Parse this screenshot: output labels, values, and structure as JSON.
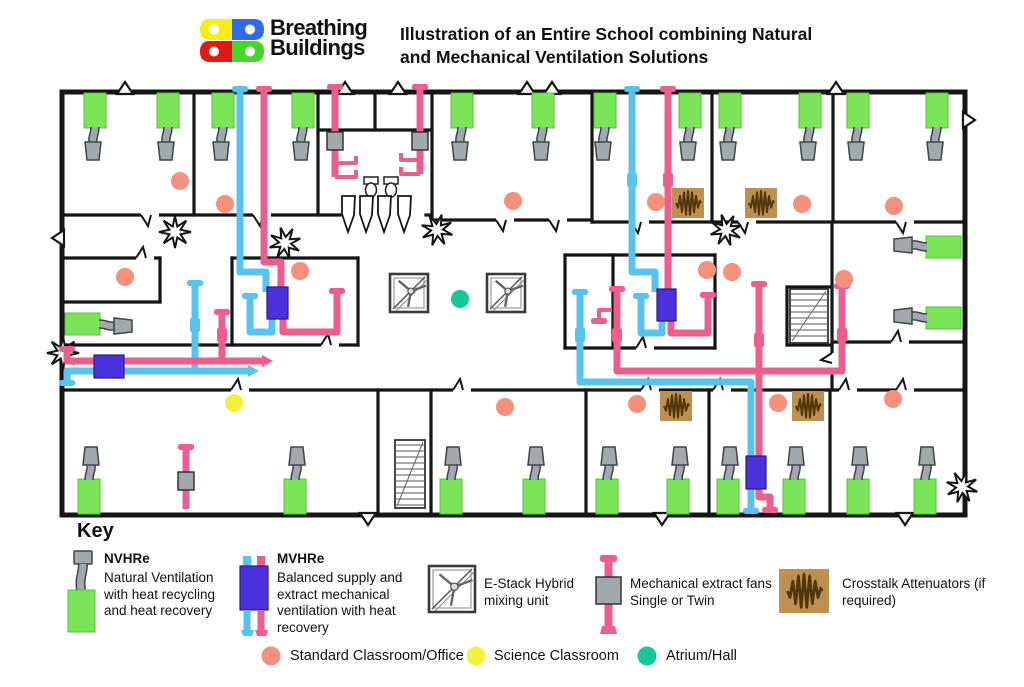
{
  "header": {
    "logo_line1": "Breathing",
    "logo_line2": "Buildings",
    "title_line1": "Illustration of an Entire School combining Natural",
    "title_line2": "and Mechanical Ventilation Solutions"
  },
  "key": {
    "heading": "Key",
    "items": [
      {
        "icon": "key-nvhre-icon",
        "title": "NVHRe",
        "desc": "Natural Ventilation with heat recycling and heat recovery"
      },
      {
        "icon": "key-mvhre-icon",
        "title": "MVHRe",
        "desc": "Balanced supply and extract mechanical ventilation with heat recovery"
      },
      {
        "icon": "key-estack-icon",
        "title": "",
        "desc": "E-Stack Hybrid mixing unit"
      },
      {
        "icon": "key-extract-fan-icon",
        "title": "",
        "desc": "Mechanical extract fans Single or Twin"
      },
      {
        "icon": "key-attenuator-icon",
        "title": "",
        "desc": "Crosstalk Attenuators (if required)"
      }
    ],
    "room_types": [
      {
        "icon": "standard-room-dot",
        "label": "Standard Classroom/Office",
        "color": "#F4907B"
      },
      {
        "icon": "science-room-dot",
        "label": "Science Classroom",
        "color": "#F2F23D"
      },
      {
        "icon": "atrium-room-dot",
        "label": "Atrium/Hall",
        "color": "#17C795"
      }
    ]
  },
  "colors": {
    "wall": "#151515",
    "green": "#79E557",
    "green_stroke": "#57BE3E",
    "gray": "#A2A9AC",
    "gray_stroke": "#3E4448",
    "blue": "#57C4F0",
    "pink": "#EE5E8D",
    "purple": "#4B31DB",
    "purple_stroke": "#2A1880",
    "salmon": "#F4907B",
    "yellow": "#F2F23D",
    "teal": "#17C795",
    "tan": "#BB9050",
    "zig": "#53350B",
    "logo_yellow": "#F7EC13",
    "logo_blue": "#2E6BE6",
    "logo_red": "#E01A10",
    "logo_green": "#44D62C"
  },
  "plan": {
    "exterior": [
      62,
      92,
      903,
      423
    ],
    "walls": [
      [
        194,
        92,
        194,
        215
      ],
      [
        318,
        92,
        318,
        215
      ],
      [
        432,
        92,
        432,
        220
      ],
      [
        592,
        92,
        592,
        222
      ],
      [
        712,
        92,
        712,
        222
      ],
      [
        833,
        92,
        833,
        222
      ],
      [
        62,
        215,
        340,
        215
      ],
      [
        426,
        215,
        432,
        215
      ],
      [
        318,
        130,
        432,
        130
      ],
      [
        375,
        92,
        375,
        130
      ],
      [
        432,
        220,
        592,
        220
      ],
      [
        592,
        222,
        965,
        222
      ],
      [
        62,
        258,
        160,
        258
      ],
      [
        160,
        258,
        160,
        302
      ],
      [
        62,
        302,
        160,
        302
      ],
      [
        62,
        345,
        358,
        345
      ],
      [
        232,
        258,
        358,
        258
      ],
      [
        232,
        258,
        232,
        345
      ],
      [
        358,
        258,
        358,
        345
      ],
      [
        565,
        255,
        715,
        255
      ],
      [
        565,
        255,
        565,
        348
      ],
      [
        613,
        255,
        613,
        348
      ],
      [
        715,
        255,
        715,
        348
      ],
      [
        565,
        348,
        715,
        348
      ],
      [
        832,
        222,
        832,
        390
      ],
      [
        787,
        287,
        832,
        287
      ],
      [
        787,
        287,
        787,
        345
      ],
      [
        787,
        345,
        832,
        345
      ],
      [
        833,
        342,
        965,
        342
      ],
      [
        62,
        390,
        965,
        390
      ],
      [
        378,
        390,
        378,
        513
      ],
      [
        431,
        390,
        431,
        513
      ],
      [
        586,
        390,
        586,
        513
      ],
      [
        709,
        390,
        709,
        513
      ],
      [
        830,
        390,
        830,
        513
      ]
    ],
    "doors": [
      [
        150,
        215,
        "d"
      ],
      [
        262,
        215,
        "d"
      ],
      [
        505,
        220,
        "d"
      ],
      [
        558,
        220,
        "d"
      ],
      [
        640,
        222,
        "d"
      ],
      [
        747,
        222,
        "d"
      ],
      [
        905,
        222,
        "d"
      ],
      [
        145,
        258,
        "u"
      ],
      [
        330,
        345,
        "u"
      ],
      [
        645,
        348,
        "u"
      ],
      [
        900,
        342,
        "u"
      ],
      [
        240,
        390,
        "u"
      ],
      [
        462,
        390,
        "u"
      ],
      [
        650,
        390,
        "u"
      ],
      [
        722,
        390,
        "u"
      ],
      [
        848,
        390,
        "u"
      ],
      [
        905,
        390,
        "u"
      ],
      [
        832,
        362,
        "l"
      ]
    ],
    "chevrons": [
      [
        125,
        92,
        "u"
      ],
      [
        345,
        92,
        "u"
      ],
      [
        398,
        92,
        "u"
      ],
      [
        527,
        92,
        "u"
      ],
      [
        552,
        92,
        "u"
      ],
      [
        836,
        92,
        "u"
      ],
      [
        368,
        515,
        "d"
      ],
      [
        662,
        515,
        "d"
      ],
      [
        905,
        515,
        "d"
      ],
      [
        965,
        120,
        "r"
      ],
      [
        62,
        238,
        "l"
      ]
    ],
    "bursts": [
      [
        175,
        232
      ],
      [
        285,
        243
      ],
      [
        437,
        230
      ],
      [
        63,
        353
      ],
      [
        726,
        230
      ],
      [
        962,
        487
      ]
    ],
    "nvhre_top": [
      95,
      168,
      223,
      303,
      462,
      543,
      605,
      690,
      730,
      810,
      858,
      937
    ],
    "nvhre_bottom": [
      89,
      295,
      451,
      534,
      607,
      678,
      728,
      794,
      858,
      925
    ],
    "nvhre_right": [
      247,
      318
    ],
    "nvhre_left": [
      [
        66,
        313
      ]
    ],
    "estacks": [
      [
        390,
        274
      ],
      [
        487,
        274
      ]
    ],
    "mvhre_boxes": [
      [
        267,
        287,
        21,
        32
      ],
      [
        94,
        355,
        30,
        23
      ],
      [
        657,
        289,
        19,
        32
      ],
      [
        746,
        456,
        20,
        33
      ]
    ],
    "attenuators": [
      [
        688,
        203
      ],
      [
        761,
        203
      ],
      [
        676,
        406
      ],
      [
        808,
        406
      ]
    ],
    "fans": [
      [
        335,
        141
      ],
      [
        420,
        141
      ],
      [
        186,
        481
      ]
    ],
    "stairs": [
      [
        395,
        440,
        30,
        68
      ],
      [
        790,
        289,
        38,
        54
      ]
    ],
    "toilets": [
      [
        371,
        186
      ],
      [
        391,
        186
      ]
    ],
    "pennants": [
      [
        342,
        196
      ],
      [
        360,
        196
      ],
      [
        378,
        196
      ],
      [
        398,
        196
      ]
    ],
    "pipes_blue": [
      [
        [
          240,
          90
        ],
        [
          240,
          272
        ],
        [
          266,
          272
        ],
        [
          266,
          292
        ]
      ],
      [
        [
          272,
          316
        ],
        [
          272,
          332
        ],
        [
          250,
          332
        ],
        [
          250,
          296
        ]
      ],
      [
        [
          195,
          283
        ],
        [
          195,
          371
        ]
      ],
      [
        [
          67,
          383
        ],
        [
          67,
          371
        ],
        [
          248,
          371
        ]
      ],
      [
        [
          632,
          90
        ],
        [
          632,
          272
        ],
        [
          655,
          272
        ],
        [
          655,
          292
        ]
      ],
      [
        [
          662,
          316
        ],
        [
          662,
          333
        ],
        [
          641,
          333
        ],
        [
          641,
          296
        ]
      ],
      [
        [
          580,
          292
        ],
        [
          580,
          382
        ],
        [
          751,
          382
        ],
        [
          751,
          511
        ]
      ]
    ],
    "pipes_pink": [
      [
        [
          264,
          90
        ],
        [
          264,
          262
        ],
        [
          281,
          262
        ],
        [
          281,
          292
        ]
      ],
      [
        [
          283,
          316
        ],
        [
          283,
          332
        ],
        [
          337,
          332
        ],
        [
          337,
          291
        ]
      ],
      [
        [
          222,
          312
        ],
        [
          222,
          361
        ]
      ],
      [
        [
          67,
          349
        ],
        [
          67,
          361
        ],
        [
          262,
          361
        ]
      ],
      [
        [
          668,
          90
        ],
        [
          668,
          292
        ]
      ],
      [
        [
          671,
          316
        ],
        [
          671,
          333
        ],
        [
          708,
          333
        ],
        [
          708,
          295
        ]
      ],
      [
        [
          617,
          289
        ],
        [
          617,
          371
        ],
        [
          842,
          371
        ],
        [
          842,
          286
        ]
      ],
      [
        [
          759,
          284
        ],
        [
          759,
          497
        ],
        [
          770,
          497
        ],
        [
          770,
          510
        ]
      ],
      [
        [
          186,
          448
        ],
        [
          186,
          509
        ]
      ],
      [
        [
          335,
          88
        ],
        [
          335,
          177
        ]
      ],
      [
        [
          420,
          88
        ],
        [
          420,
          174
        ]
      ]
    ],
    "pipes_pink_thin": [
      [
        [
          335,
          163
        ],
        [
          356,
          163
        ],
        [
          356,
          156
        ]
      ],
      [
        [
          335,
          177
        ],
        [
          356,
          177
        ],
        [
          356,
          170
        ]
      ],
      [
        [
          420,
          160
        ],
        [
          401,
          160
        ],
        [
          401,
          153
        ]
      ],
      [
        [
          420,
          174
        ],
        [
          401,
          174
        ],
        [
          401,
          167
        ]
      ],
      [
        [
          612,
          310
        ],
        [
          599,
          310
        ],
        [
          599,
          321
        ]
      ]
    ],
    "caps": [
      [
        "b",
        195,
        283
      ],
      [
        "b",
        580,
        292
      ],
      [
        "b",
        641,
        296
      ],
      [
        "b",
        250,
        296
      ],
      [
        "b",
        67,
        383
      ],
      [
        "b",
        751,
        511
      ],
      [
        "b",
        240,
        89
      ],
      [
        "b",
        632,
        89
      ],
      [
        "p",
        222,
        312
      ],
      [
        "p",
        617,
        289
      ],
      [
        "p",
        842,
        286
      ],
      [
        "p",
        759,
        284
      ],
      [
        "p",
        67,
        349
      ],
      [
        "p",
        337,
        291
      ],
      [
        "p",
        708,
        295
      ],
      [
        "p",
        186,
        447
      ],
      [
        "p",
        770,
        510
      ],
      [
        "p",
        264,
        89
      ],
      [
        "p",
        668,
        89
      ],
      [
        "p",
        335,
        87
      ],
      [
        "p",
        420,
        87
      ],
      [
        "p",
        599,
        321
      ]
    ],
    "joints": [
      [
        "b",
        195,
        325
      ],
      [
        "b",
        580,
        335
      ],
      [
        "b",
        632,
        180
      ],
      [
        "p",
        222,
        335
      ],
      [
        "p",
        617,
        335
      ],
      [
        "p",
        759,
        340
      ],
      [
        "p",
        842,
        335
      ],
      [
        "p",
        668,
        180
      ]
    ],
    "arrows": [
      [
        262,
        361,
        "p"
      ],
      [
        248,
        371,
        "b"
      ]
    ],
    "dots_standard": [
      [
        180,
        181
      ],
      [
        225,
        204
      ],
      [
        513,
        201
      ],
      [
        656,
        202
      ],
      [
        802,
        204
      ],
      [
        894,
        206
      ],
      [
        125,
        277
      ],
      [
        300,
        271
      ],
      [
        707,
        270
      ],
      [
        732,
        272
      ],
      [
        844,
        279
      ],
      [
        505,
        407
      ],
      [
        637,
        404
      ],
      [
        778,
        403
      ],
      [
        893,
        399
      ]
    ],
    "dots_science": [
      [
        234,
        403
      ]
    ],
    "dots_atrium": [
      [
        460,
        299
      ]
    ]
  }
}
